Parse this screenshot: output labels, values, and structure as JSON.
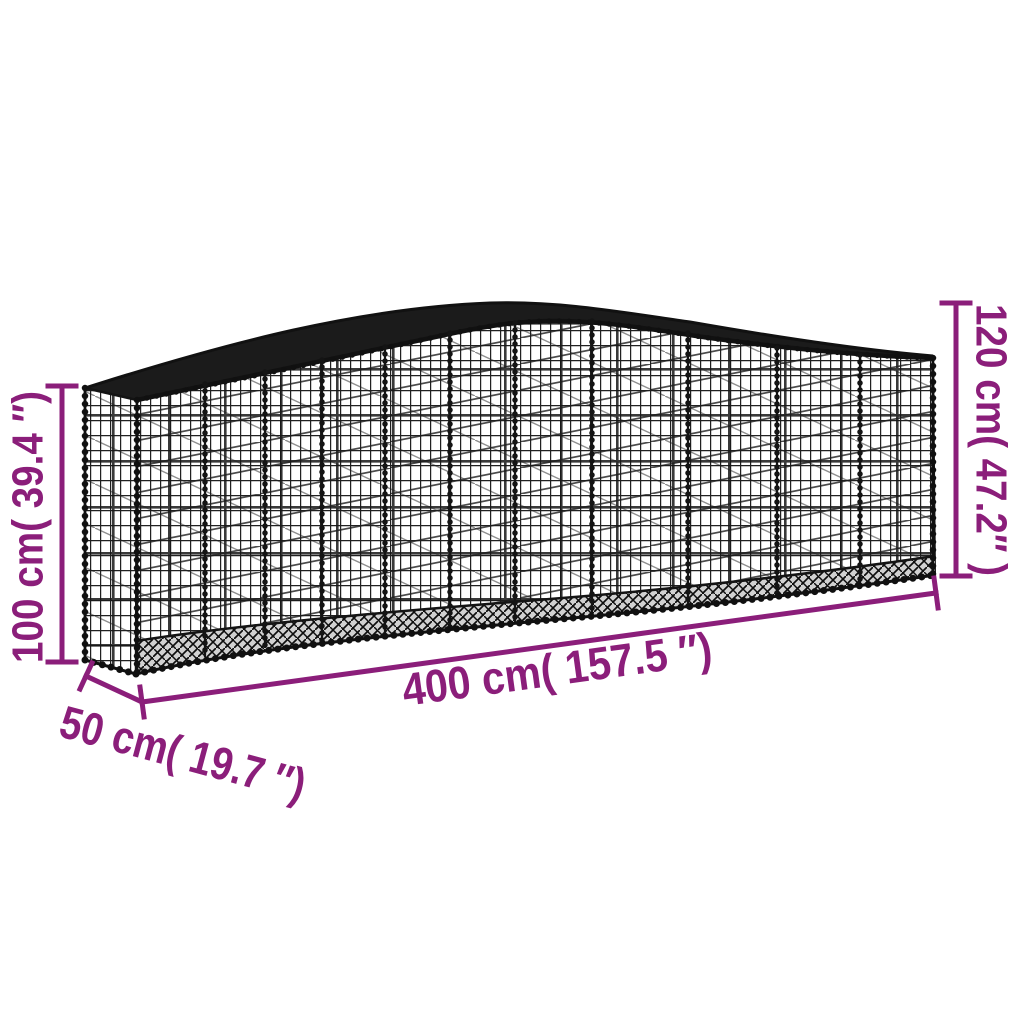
{
  "figure": {
    "kind": "product-dimension-diagram"
  },
  "dimensions": {
    "side_height": "100 cm( 39.4 ″)",
    "total_height": "120 cm( 47.2″ )",
    "length": "400 cm( 157.5 ″)",
    "depth": "50 cm( 19.7 ″)"
  },
  "colors": {
    "accent": "#8B1E7A",
    "wire": "#1A1A1A",
    "background": "#FFFFFF"
  }
}
